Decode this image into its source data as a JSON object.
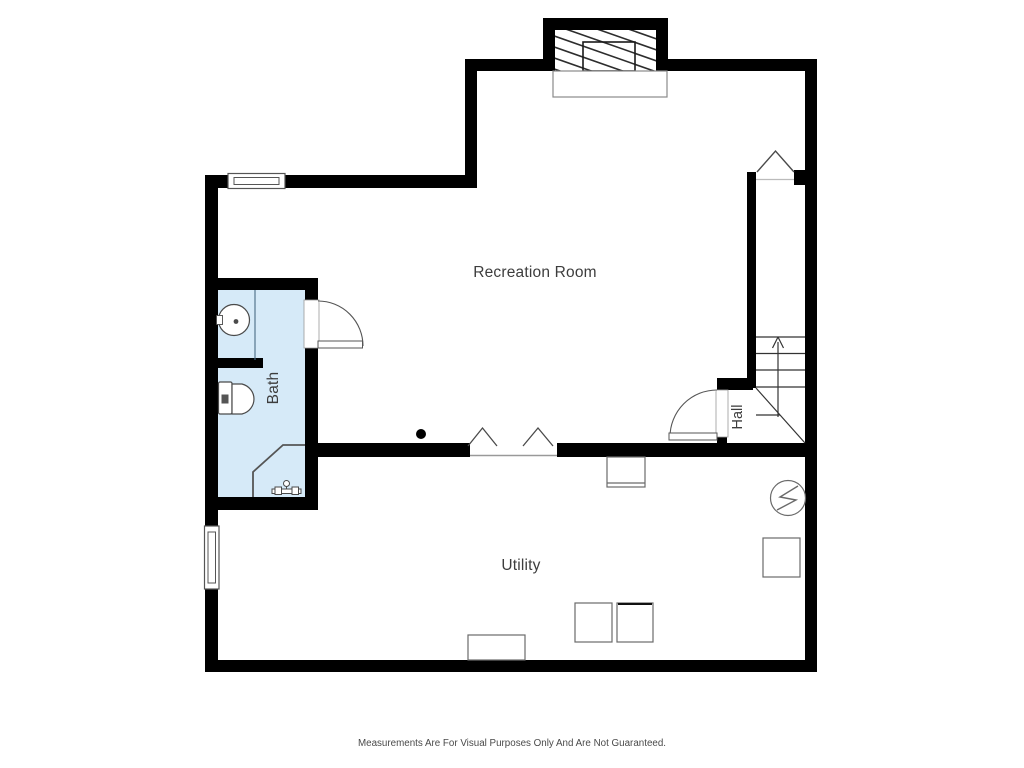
{
  "page": {
    "background": "#ffffff",
    "disclaimer": "Measurements Are For Visual Purposes Only And Are Not Guaranteed."
  },
  "floor_plan": {
    "rooms": [
      {
        "id": "recreation-room",
        "label": "Recreation Room"
      },
      {
        "id": "bath",
        "label": "Bath"
      },
      {
        "id": "hall",
        "label": "Hall"
      },
      {
        "id": "utility",
        "label": "Utility"
      }
    ],
    "colors": {
      "wall": "#000000",
      "bath_fill": "#d6eaf8",
      "fixture_line": "#4a4a4a",
      "thin_line": "#999999",
      "label_text": "#3d3d3d"
    },
    "symbols": [
      "fireplace-icon",
      "hearth-icon",
      "window-icon",
      "door-swing-icon",
      "stairs-up-icon",
      "up-arrow-icon",
      "opening-chevron-icon",
      "pedestal-sink-icon",
      "toilet-icon",
      "corner-shower-icon",
      "shower-valve-icon",
      "electrical-panel-icon",
      "water-heater-icon",
      "washer-icon",
      "dryer-icon",
      "laundry-tub-icon",
      "column-dot-icon"
    ]
  }
}
